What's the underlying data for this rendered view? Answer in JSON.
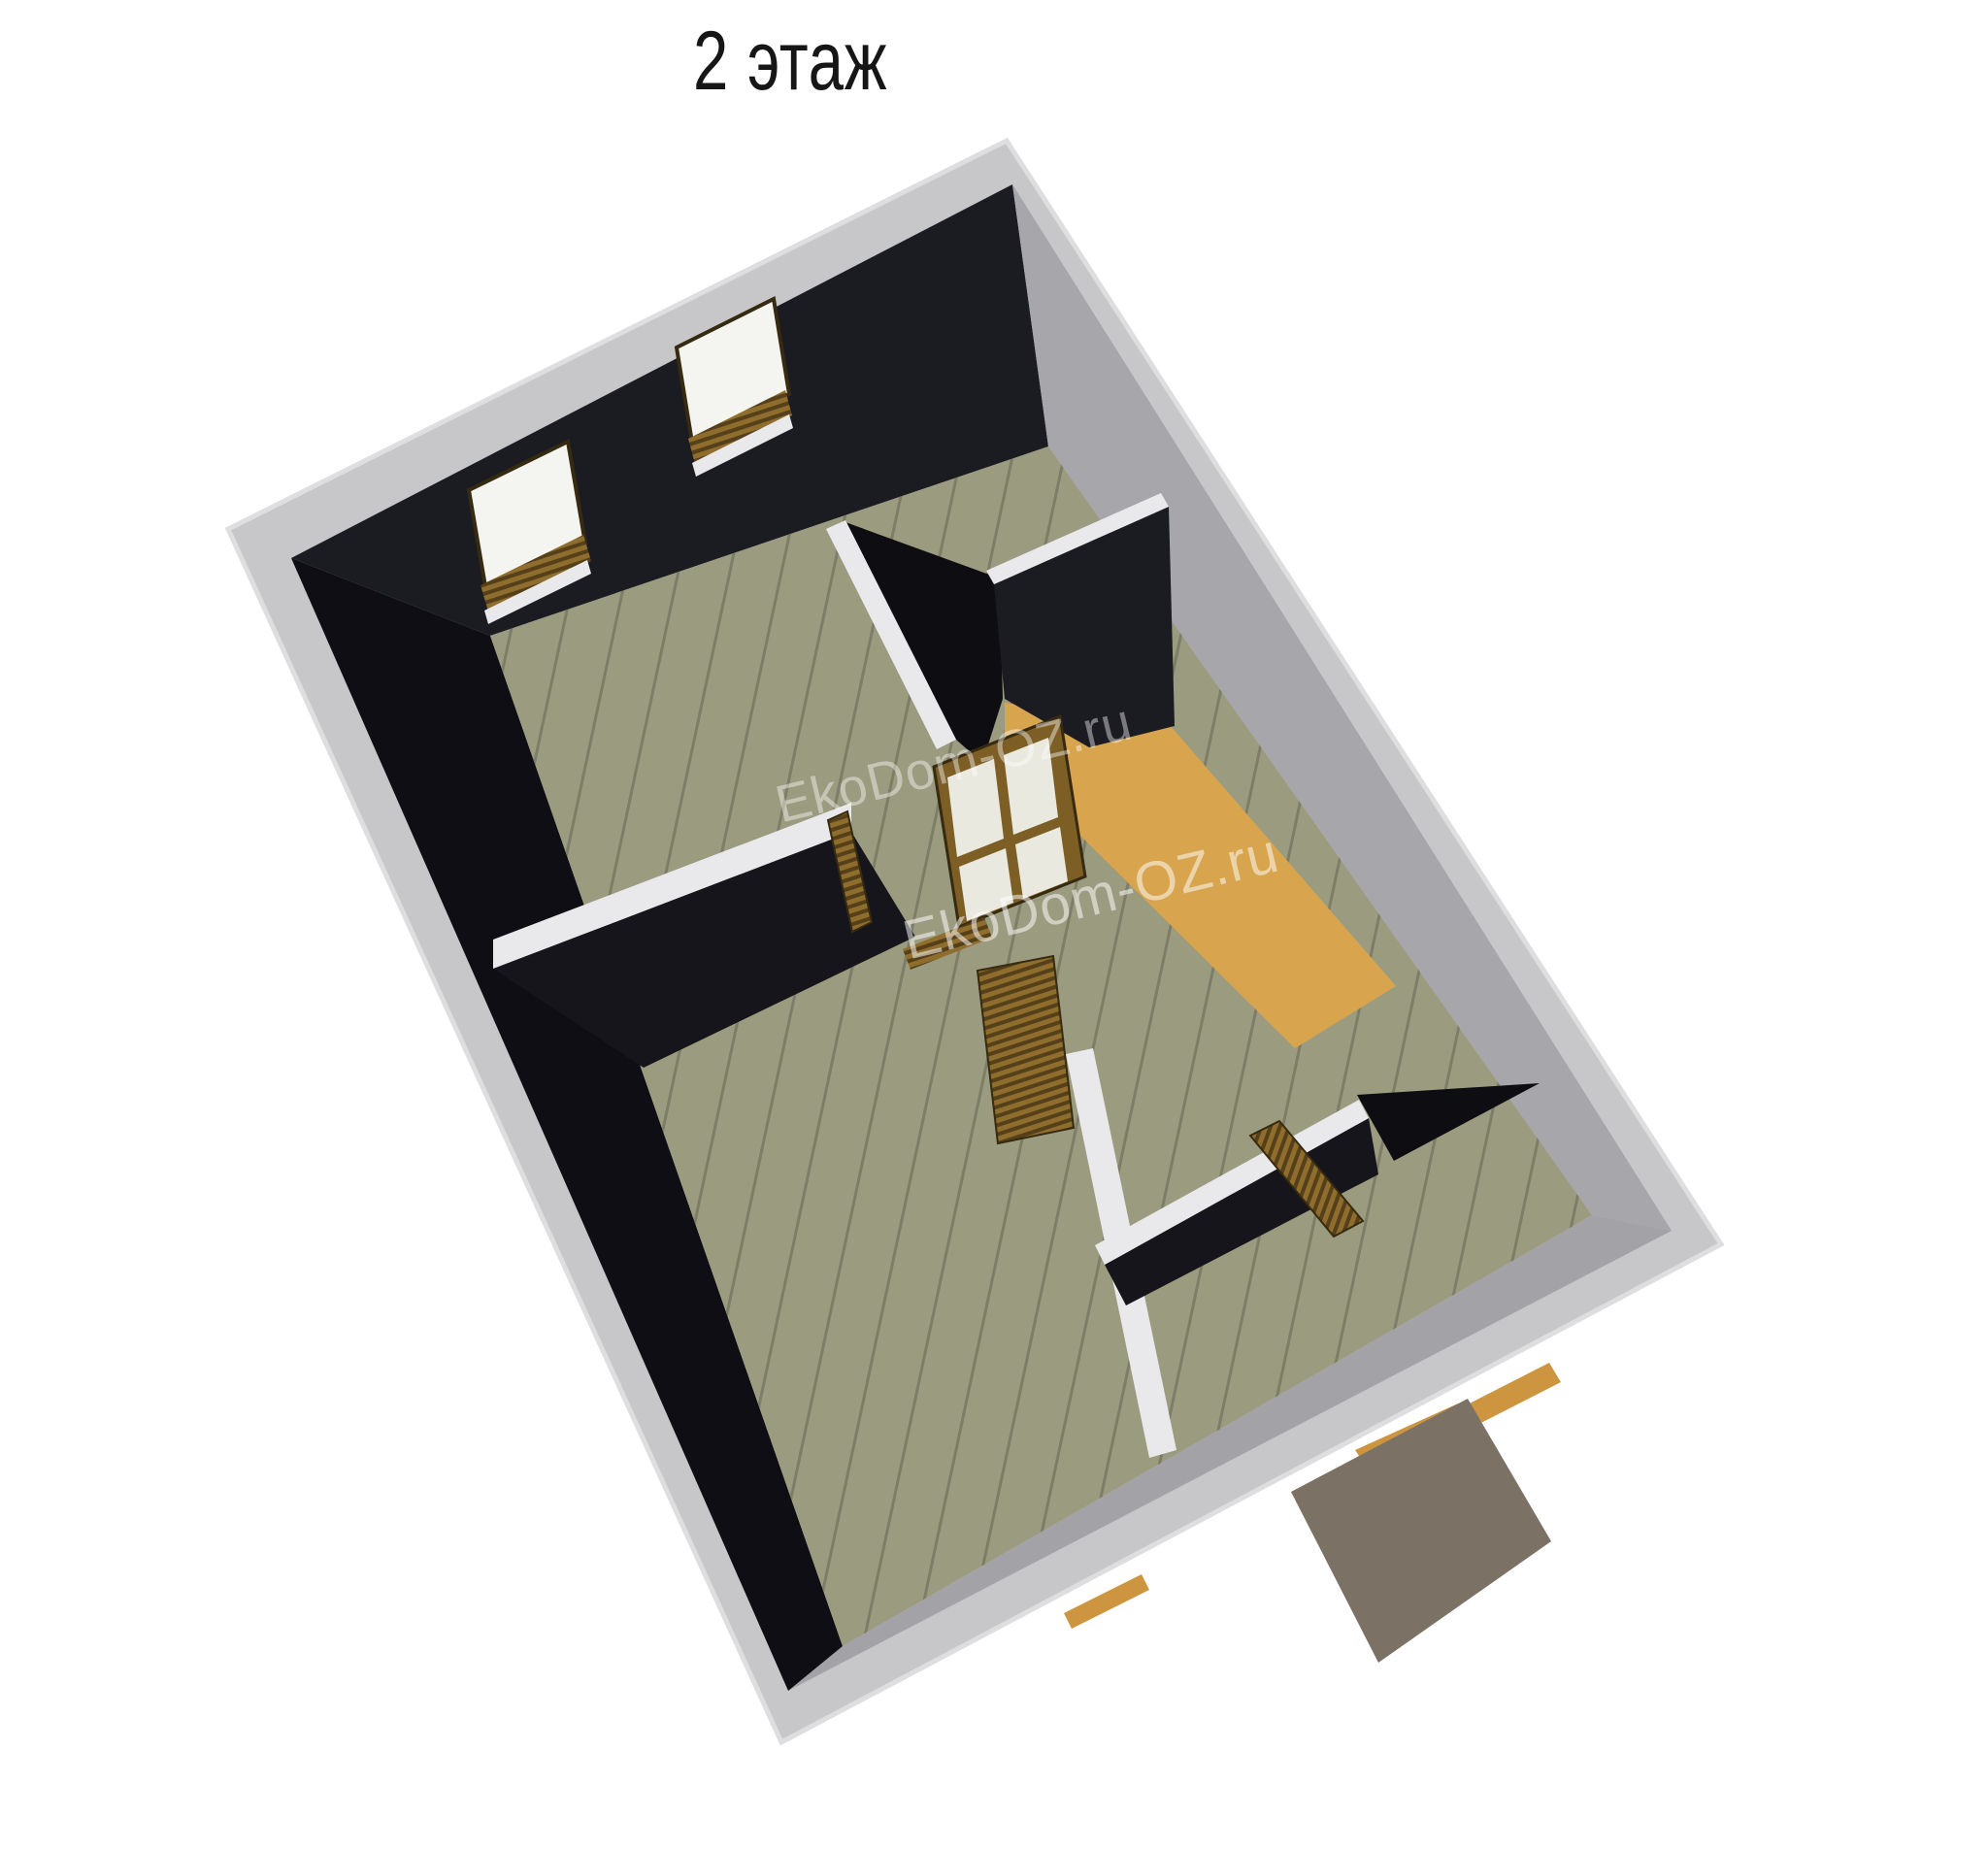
{
  "title": {
    "text": "2 этаж"
  },
  "watermark": {
    "text": "EkoDom-OZ.ru"
  },
  "colors": {
    "band": "#c7c7c9",
    "band_edge": "#dedee0",
    "wall_dark": "#1b1b22",
    "wall_dark2": "#0e0e14",
    "wall_dark3": "#15151b",
    "wall_void": "#0d0d12",
    "wall_lit": "#a7a7ab",
    "wall_lit2": "#a3a3a7",
    "white_band": "#e9e9eb",
    "floor": "#9b9b80",
    "plank": "#7d7e67",
    "stairs": "#d8a54e",
    "sill": "#cd9540",
    "porch": "#7b7164",
    "wood_light": "#8f6d2c",
    "wood_dark": "#55401a",
    "frame": "#7d5f26",
    "frame_outline": "#362a10",
    "glass": "#f4f4f0",
    "glass2": "#e9e9df"
  }
}
